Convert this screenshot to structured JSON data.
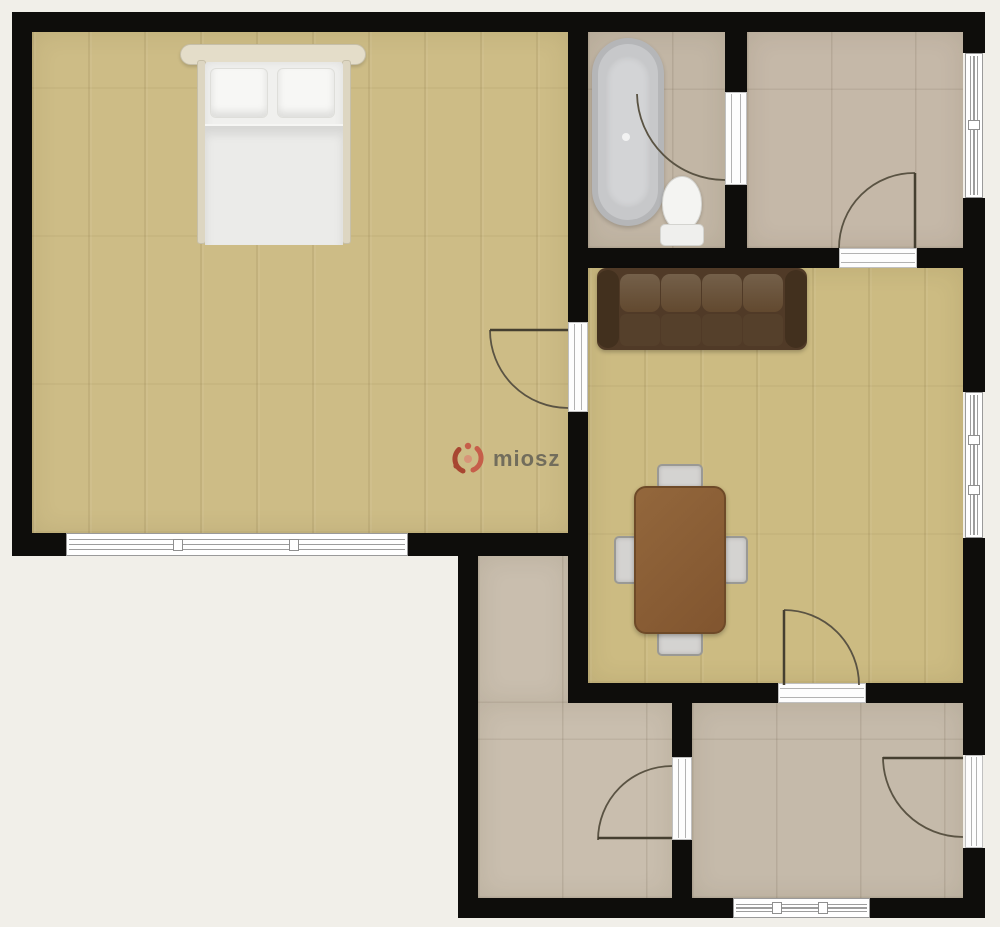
{
  "watermark": {
    "text": "miosz",
    "logo": "miosz-logo"
  },
  "palette": {
    "background": "#f1efe9",
    "wall": "#0e0d0b",
    "wood_floor": "#cdbc86",
    "tile_floor": "#c6baaa",
    "window_white": "#ffffff",
    "window_line": "#9d9d9d",
    "door_arc": "#5a5343",
    "sofa_dark": "#503a27",
    "sofa_cushion": "#74604a",
    "table_brown": "#8a5d35",
    "chair_gray": "#d4d3d1",
    "bed_white": "#f0f0ee",
    "headboard_cream": "#e4ddc9",
    "bathtub_gray": "#c7c8ca",
    "toilet_white": "#f4f4f2",
    "logo_red": "#c0503c",
    "watermark_text_color": "#6b6759"
  },
  "rooms": [
    {
      "id": "bedroom",
      "floor": "wood",
      "furniture": [
        "double-bed"
      ]
    },
    {
      "id": "bathroom",
      "floor": "tile",
      "furniture": [
        "bathtub",
        "toilet"
      ]
    },
    {
      "id": "top-right-room",
      "floor": "tile",
      "furniture": []
    },
    {
      "id": "living-dining-room",
      "floor": "wood",
      "furniture": [
        "sofa",
        "dining-table",
        "chair",
        "chair",
        "chair",
        "chair"
      ]
    },
    {
      "id": "hallway",
      "floor": "tile",
      "furniture": []
    },
    {
      "id": "bottom-right-room",
      "floor": "tile",
      "furniture": []
    }
  ],
  "openings": {
    "windows": 4,
    "doors": 6
  }
}
